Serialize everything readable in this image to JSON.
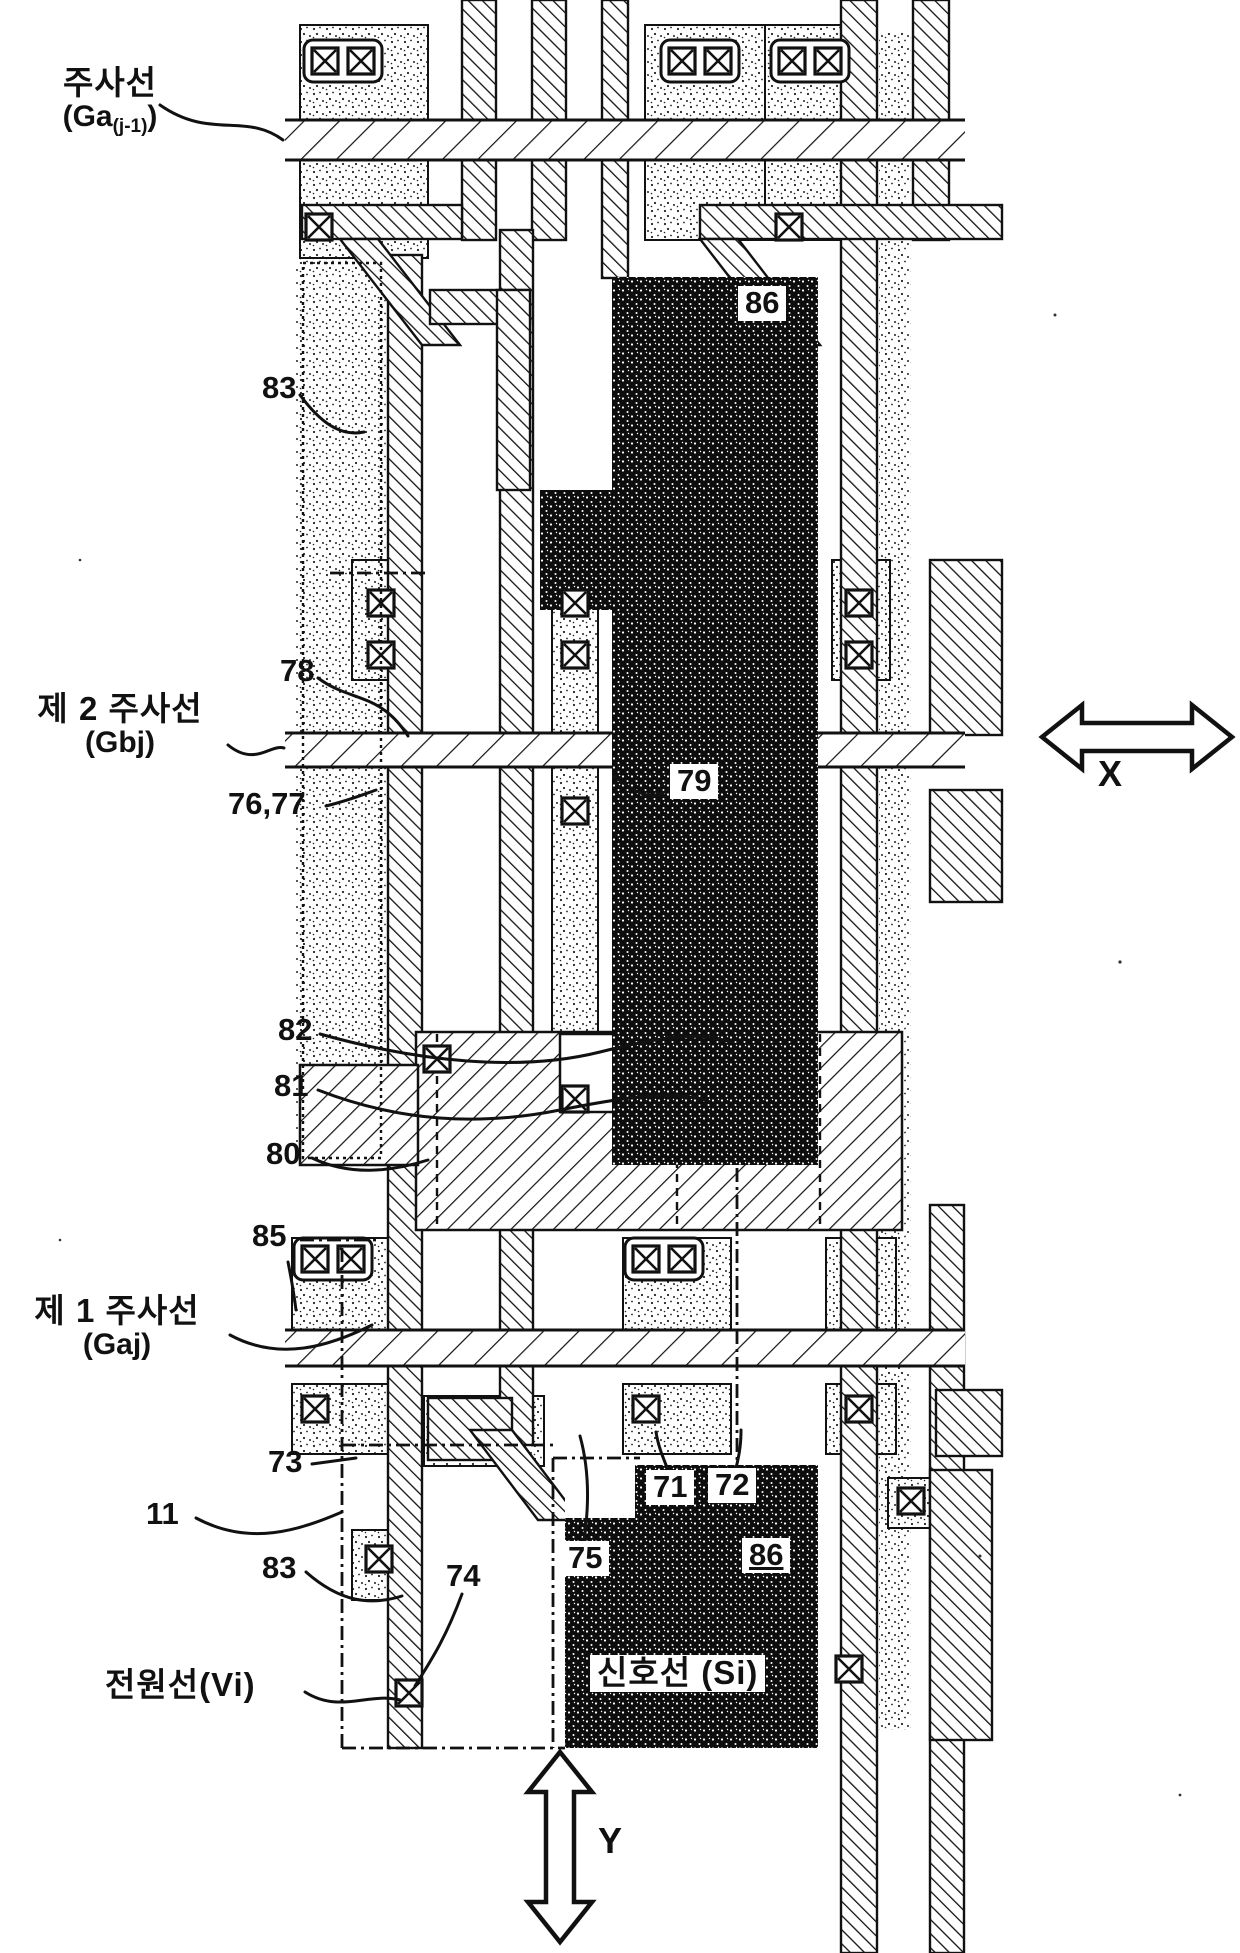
{
  "figure": {
    "labels": {
      "scan_line_prev_l1": "주사선",
      "scan_line_prev_l2a": "(Ga",
      "scan_line_prev_sub": "(j-1)",
      "scan_line_prev_l2b": ")",
      "second_scan_l1": "제 2 주사선",
      "second_scan_l2": "(Gbj)",
      "first_scan_l1": "제 1 주사선",
      "first_scan_l2": "(Gaj)",
      "power_line": "전원선(Vi)",
      "signal_line": "신호선 (Si)",
      "axis_x": "X",
      "axis_y": "Y"
    },
    "ref_numbers": {
      "n83_top": "83",
      "n78": "78",
      "n76_77": "76,77",
      "n79": "79",
      "n86_top": "86",
      "n82": "82",
      "n81": "81",
      "n80": "80",
      "n85": "85",
      "n73": "73",
      "n11": "11",
      "n83_bottom": "83",
      "n74": "74",
      "n75": "75",
      "n71": "71",
      "n72": "72",
      "n86_bottom": "86"
    },
    "icons": {
      "contact_via": "⊠ (square with X = contact hole)"
    },
    "colors": {
      "ink": "#111111",
      "paper": "#ffffff"
    }
  }
}
